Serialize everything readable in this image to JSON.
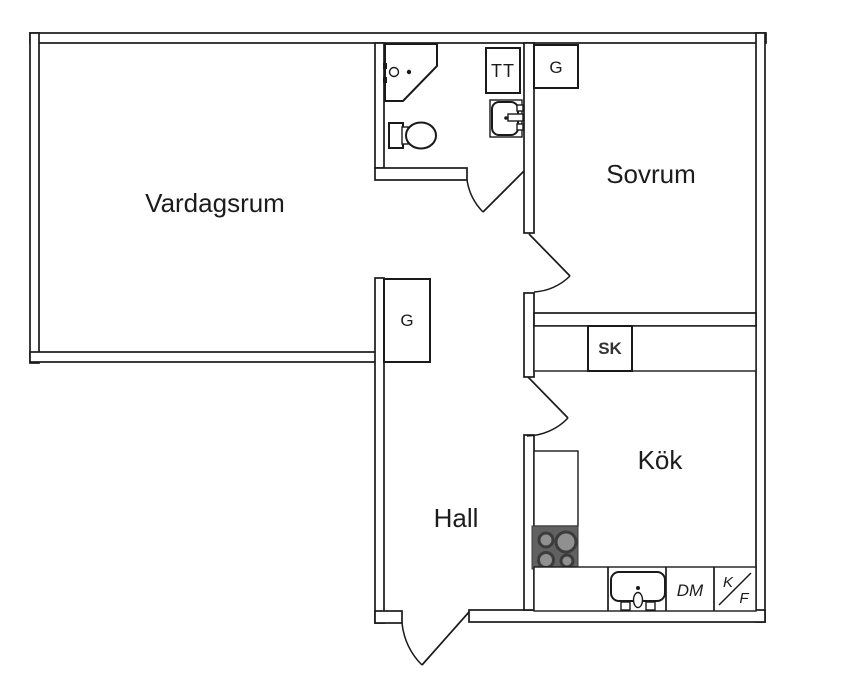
{
  "plan": {
    "type": "apartment-floor-plan",
    "rooms": {
      "living": {
        "label": "Vardagsrum"
      },
      "bedroom": {
        "label": "Sovrum"
      },
      "hall": {
        "label": "Hall"
      },
      "kitchen": {
        "label": "Kök"
      }
    },
    "fixtures": {
      "washer": {
        "label": "TT"
      },
      "wardrobe_bedroom": {
        "label": "G"
      },
      "wardrobe_hall": {
        "label": "G"
      },
      "cleaning_cabinet": {
        "label": "SK"
      },
      "dishwasher": {
        "label": "DM"
      },
      "fridge_freezer": {
        "label_top": "K",
        "label_bottom": "F"
      }
    },
    "icons": [
      "shower-icon",
      "toilet-icon",
      "washbasin-icon",
      "kitchen-sink-icon",
      "stove-icon",
      "door-swing-icon"
    ],
    "colors": {
      "line": "#1a1a1a",
      "wall_fill": "#ffffff",
      "label": "#1c1c1c",
      "muted_label": "#7b7b7b",
      "stove_body": "#616161",
      "burner_fill": "#909090",
      "burner_ring": "#3c3c3c"
    }
  }
}
